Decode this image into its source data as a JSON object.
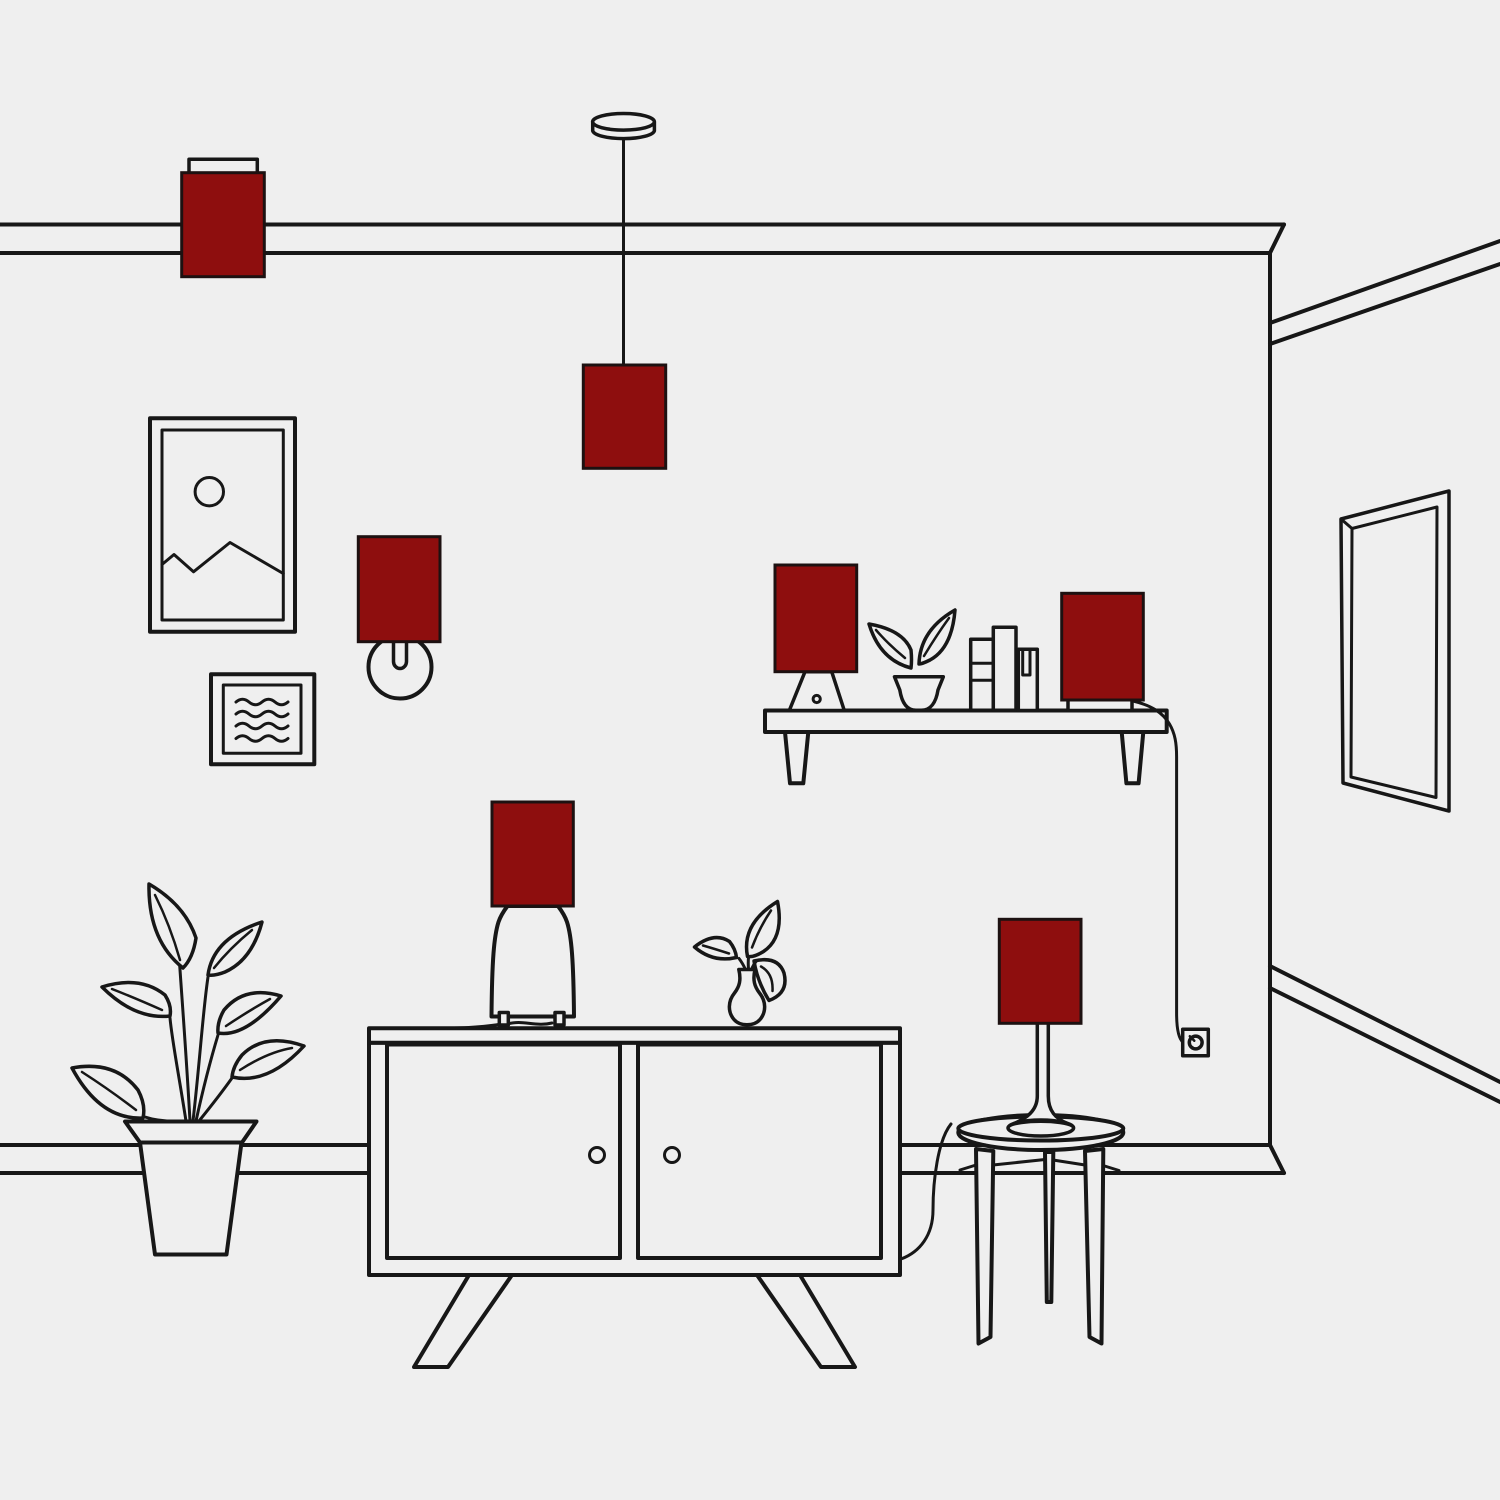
{
  "scene": {
    "description": "Minimal line-art illustration of a living room wall where every lamp shade is highlighted in dark red",
    "colors": {
      "background": "#EFEFEF",
      "line": "#171717",
      "lampshade_red": "#8E0E0E"
    },
    "lamp_shade_count": 7,
    "lamps": [
      "flush ceiling lamp (top left)",
      "pendant lamp (top center)",
      "wall sconce (left)",
      "table lamp on sideboard",
      "small lamp on shelf left",
      "accent lamp on shelf right",
      "table lamp on round side table"
    ],
    "furniture": [
      "wall shelf with tapered legs",
      "two-door sideboard with splayed legs",
      "round three-leg side table",
      "perspective mirror on right wall"
    ],
    "decor": [
      "framed landscape picture with sun and mountains",
      "small framed abstract picture with wavy lines",
      "large floor plant in tapered pot",
      "sprout in bowl pot on shelf",
      "three books on shelf",
      "bud vase with plant on sideboard",
      "wall outlet with plugged-in cord"
    ]
  }
}
